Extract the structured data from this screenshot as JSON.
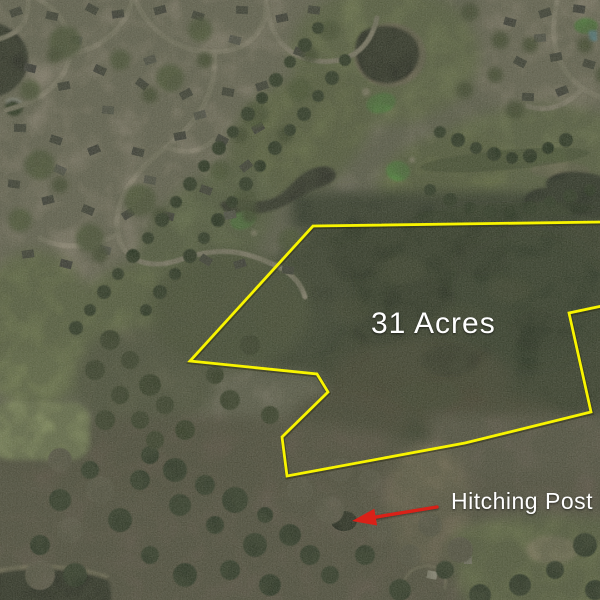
{
  "map": {
    "view_label": "aerial-satellite-view",
    "parcel": {
      "acreage_label": "31 Acres",
      "label_color": "#ffffff",
      "label_x": 371,
      "label_y": 333,
      "boundary_color": "#f8f400",
      "boundary_points": "602,222 313,226 190,361 317,374 328,392 282,437 287,476 465,443 591,412 569,313 602,306"
    },
    "callout": {
      "label": "Hitching Post Lu",
      "label_color": "#ffffff",
      "label_x": 451,
      "label_y": 509,
      "arrow_color": "#d92118",
      "arrow_tail": {
        "x": 437,
        "y": 507
      },
      "arrow_tip": {
        "x": 352,
        "y": 521
      }
    }
  }
}
